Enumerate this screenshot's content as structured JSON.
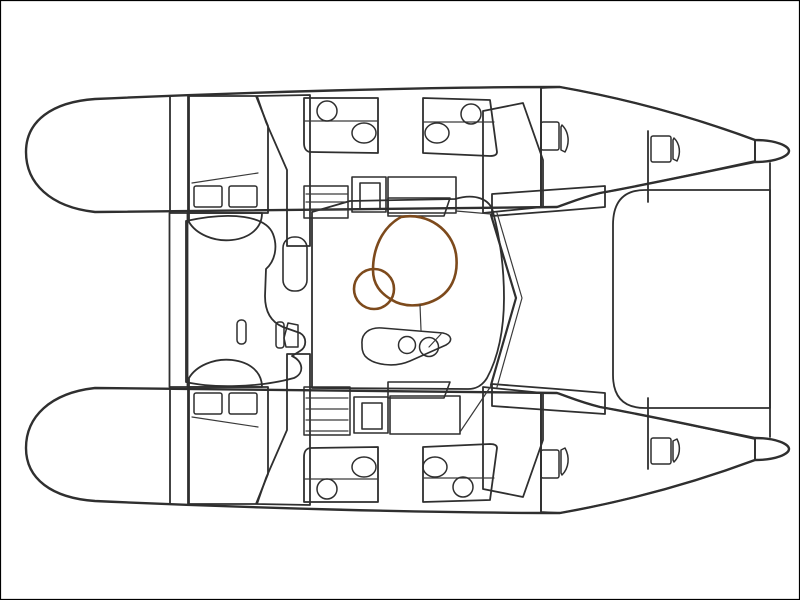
{
  "labels": {
    "extra_toilet": "+ WC"
  },
  "colors": {
    "background": "#ffffff",
    "border": "#000000",
    "outline": "#2f2f2f",
    "line_thin": "#3a3a3a",
    "hull_white": "#ffffff",
    "cabin_teal": "#a7d5d1",
    "berth_blue": "#a9c9ea",
    "head_olive": "#c2c18a",
    "salon_orange": "#f9ca98",
    "counter_gray": "#c9c9c9",
    "table_outline": "#7d4a1c",
    "text": "#111111"
  }
}
